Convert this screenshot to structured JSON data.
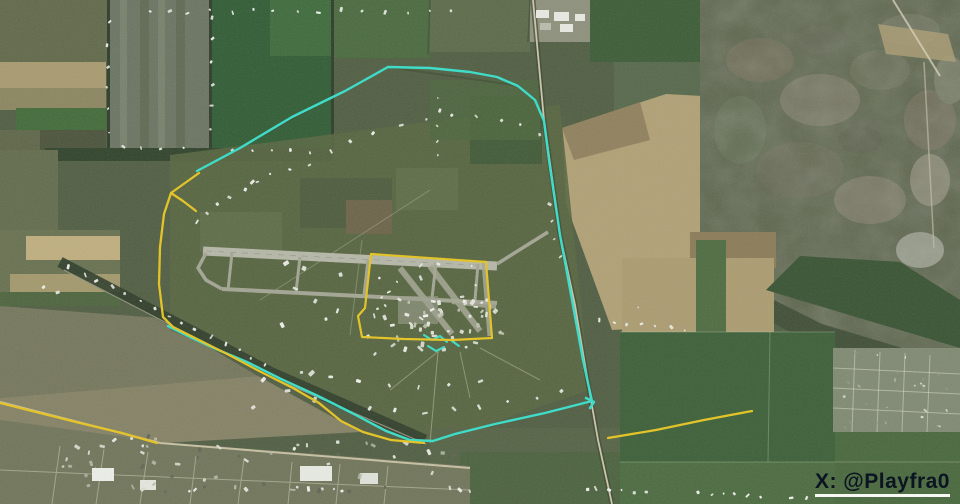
{
  "map": {
    "description": "Satellite view of a military airfield surrounded by farm fields, with annotated defensive perimeter lines",
    "colors": {
      "cyan_annotation": "#35dfca",
      "yellow_annotation": "#e6c41e",
      "watermark_text": "#0c1422",
      "watermark_underline": "#f7f7f4"
    },
    "annotations": {
      "cyan_perimeter": "197,171 240,148 292,117 345,91 388,67 430,68 470,72 497,77 518,86 535,100 544,121 549,160 560,235 572,300 583,360 588,383 592,401 545,413 495,424 455,434 433,441 410,440 386,431 352,413 316,395 281,379 247,362 216,349 190,337 168,326",
      "cyan_mark_1": "424,335 432,340 440,336 447,342",
      "cyan_mark_2": "428,346 436,351 444,347",
      "cyan_mark_3": "452,341 459,346",
      "cyan_mark_4": "586,398 594,402 590,408",
      "yellow_west_arc": "199,173 171,193 164,214 160,247 159,284 163,317 173,327 199,340 229,355 259,371 293,388 319,403 341,421 363,432 391,440 424,443",
      "yellow_spur": "171,193 183,201 196,211",
      "yellow_apron_box": "371,254 486,262 492,338 452,340 404,339 362,337 358,316 365,308 371,254",
      "yellow_sw_road": "0,403 40,413 80,423 122,433 157,443",
      "yellow_se_road": "608,438 656,430 704,420 752,411"
    }
  },
  "watermark": {
    "text": "X: @Playfra0"
  }
}
